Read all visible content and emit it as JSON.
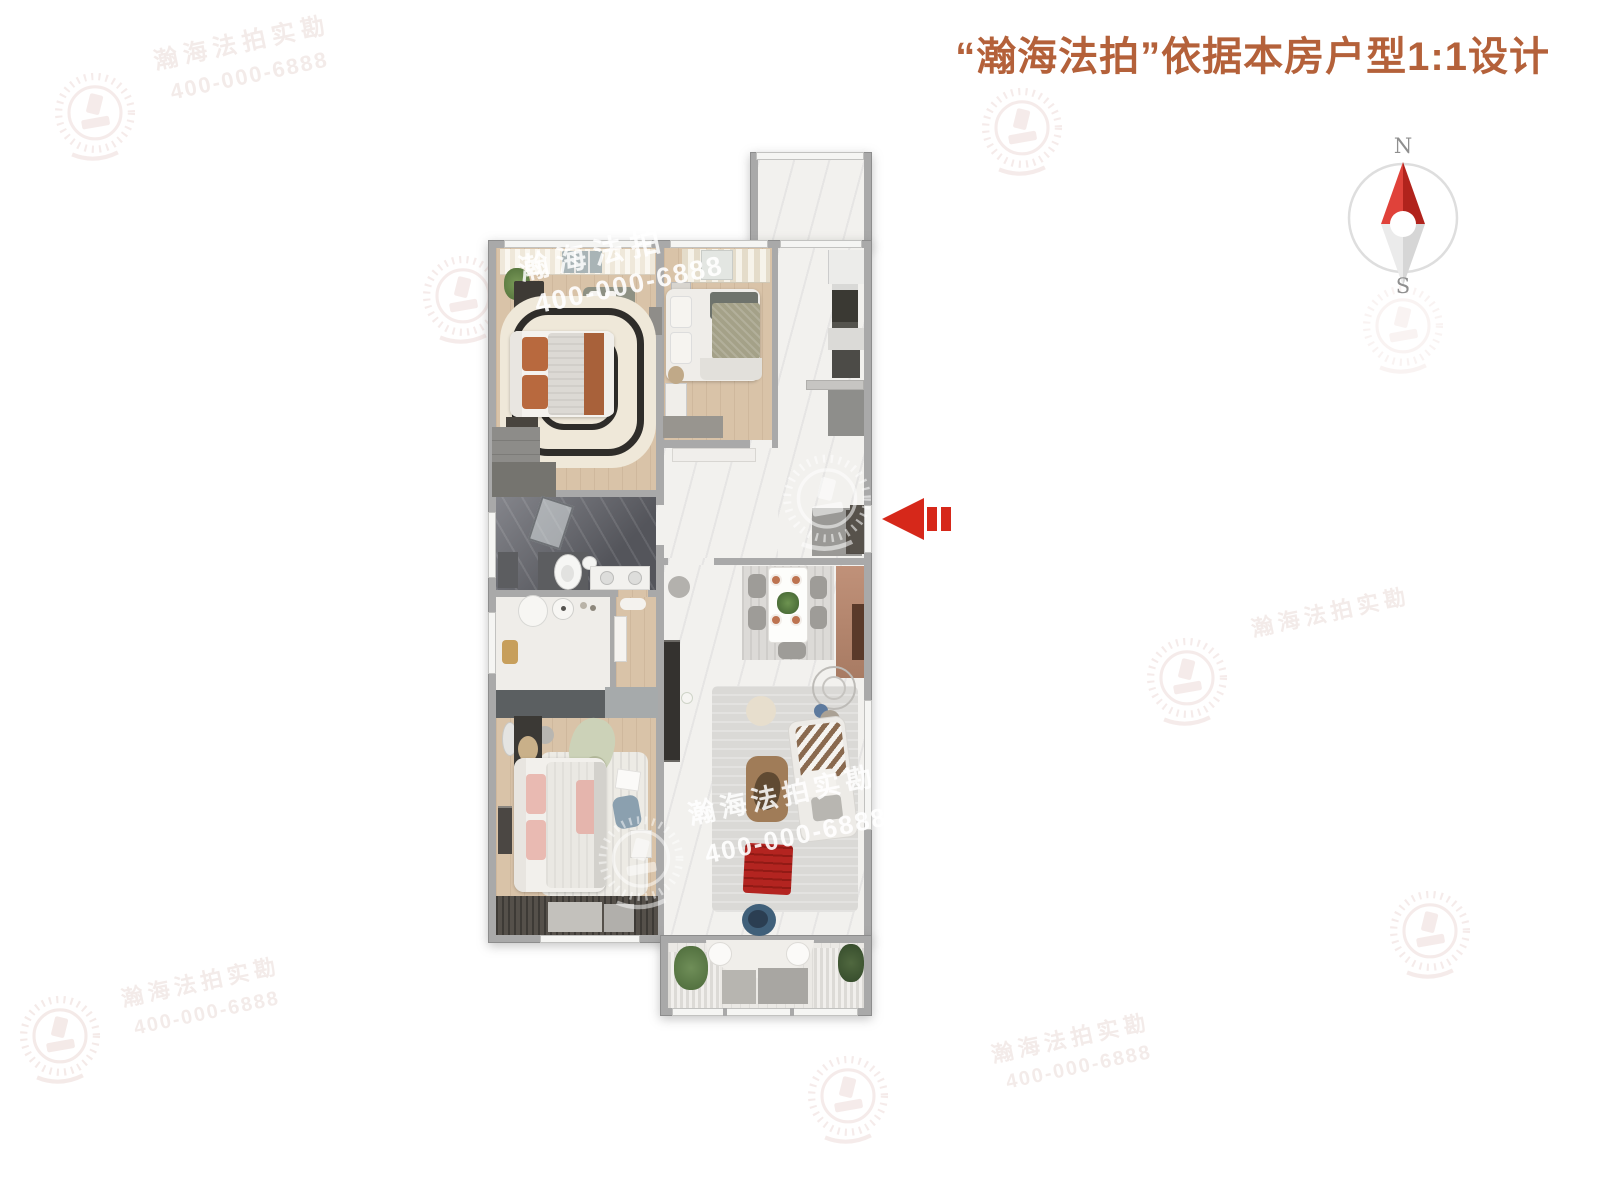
{
  "header": {
    "title": "“瀚海法拍”依据本房户型1:1设计",
    "title_color": "#b4613a"
  },
  "compass": {
    "north": "N",
    "south": "S",
    "needle_red": "#c62a22",
    "needle_gray": "#d6d6d6"
  },
  "entry_arrow": {
    "icon": "entry-direction-arrow-left",
    "color": "#d6281a"
  },
  "watermarks": {
    "brand": "瀚海法拍",
    "brand_survey": "瀚海法拍实勘",
    "phone": "400-000-6888",
    "logo_icon": "gavel-wreath-logo"
  }
}
